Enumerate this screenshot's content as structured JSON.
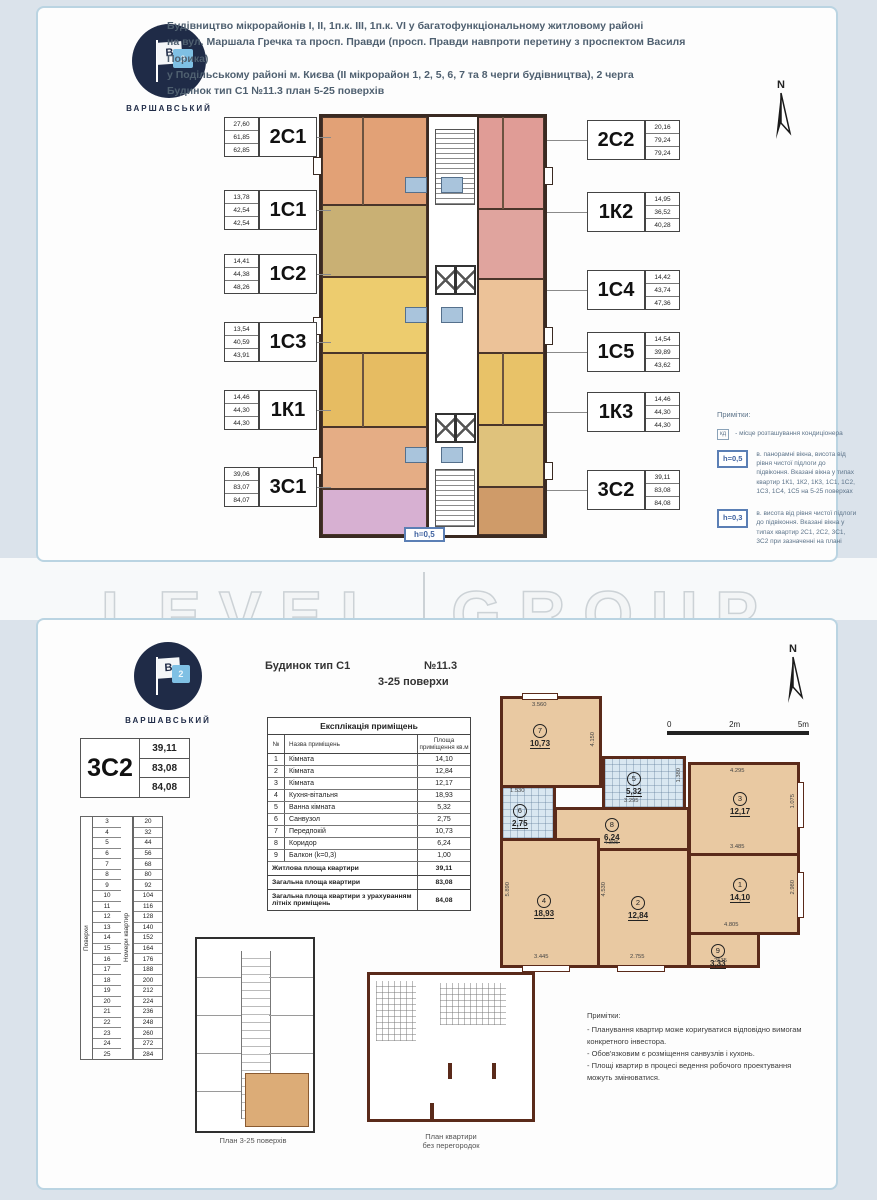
{
  "palette": {
    "page_bg": "#dbe3eb",
    "doc_border": "#bad4e2",
    "wall_dark": "#3a2a22",
    "wall_brown": "#5a2a1a",
    "room_tan": "#e9c9a2",
    "tile_blue": "#d9e7f1",
    "logo_navy": "#1f2b47",
    "logo_blue": "#7fc0e4",
    "tag_blue": "#3f62a0",
    "units": {
      "u2C1": "#e2a176",
      "u1C1": "#c9b074",
      "u1C2": "#edcc6e",
      "u1C3": "#e6bc62",
      "u1K1": "#e5ad85",
      "u3C1": "#d7b0d2",
      "u2C2": "#e09c96",
      "u1K2": "#e0a49e",
      "u1C4": "#ecc298",
      "u1C5": "#e8c268",
      "u1K3": "#dfc27c",
      "u3C2": "#cf9b69"
    }
  },
  "watermark": {
    "left": "LEVEL",
    "right": "GROUP"
  },
  "top_doc": {
    "logo": {
      "brand": "ВАРШАВСЬКИЙ",
      "flag_letter": "В",
      "flag_number": "2"
    },
    "header_lines": [
      "Будівництво мікрорайонів I, II, 1п.к. III, 1п.к. VI у багатофункціональному житловому районі",
      "на вул. Маршала Гречка та просп. Правди (просп. Правди навпроти перетину з проспектом Василя Порика)",
      "у Подільському районі м. Києва (II мікрорайон 1, 2, 5, 6, 7 та 8 черги будівництва), 2 черга",
      "Будинок тип С1    №11.3    план 5-25 поверхів"
    ],
    "north_label": "N",
    "left_units": [
      {
        "code": "2С1",
        "values": [
          "27,60",
          "61,85",
          "62,85"
        ]
      },
      {
        "code": "1С1",
        "values": [
          "13,78",
          "42,54",
          "42,54"
        ]
      },
      {
        "code": "1С2",
        "values": [
          "14,41",
          "44,38",
          "48,26"
        ]
      },
      {
        "code": "1С3",
        "values": [
          "13,54",
          "40,59",
          "43,91"
        ]
      },
      {
        "code": "1К1",
        "values": [
          "14,46",
          "44,30",
          "44,30"
        ]
      },
      {
        "code": "3С1",
        "values": [
          "39,06",
          "83,07",
          "84,07"
        ]
      }
    ],
    "right_units": [
      {
        "code": "2С2",
        "values": [
          "20,16",
          "79,24",
          "79,24"
        ]
      },
      {
        "code": "1К2",
        "values": [
          "14,95",
          "36,52",
          "40,28"
        ]
      },
      {
        "code": "1С4",
        "values": [
          "14,42",
          "43,74",
          "47,36"
        ]
      },
      {
        "code": "1С5",
        "values": [
          "14,54",
          "39,89",
          "43,62"
        ]
      },
      {
        "code": "1К3",
        "values": [
          "14,46",
          "44,30",
          "44,30"
        ]
      },
      {
        "code": "3С2",
        "values": [
          "39,11",
          "83,08",
          "84,08"
        ]
      }
    ],
    "plan_tag": "h=0,5",
    "notes": {
      "title": "Примітки:",
      "ac_symbol": "кд",
      "ac_text": "- місце розташування кондиціонера",
      "items": [
        {
          "tag": "h=0,5",
          "text": "в. панорамні вікна, висота від рівня чистої підлоги до підвіконня. Вказані вікна у типах квартир 1К1, 1К2, 1К3, 1С1, 1С2, 1С3, 1С4, 1С5 на 5-25 поверхах"
        },
        {
          "tag": "h=0,3",
          "text": "в. висота від рівня чистої підлоги до підвіконня. Вказані вікна у типах квартир 2С1, 2С2, 3С1, 3С2 при зазначенні на плані"
        }
      ]
    }
  },
  "bottom_doc": {
    "logo": {
      "brand": "ВАРШАВСЬКИЙ",
      "flag_letter": "В",
      "flag_number": "2"
    },
    "header": {
      "building": "Будинок тип С1",
      "number": "№11.3",
      "floors": "3-25 поверхи"
    },
    "north_label": "N",
    "unit_summary": {
      "code": "3С2",
      "values": [
        "39,11",
        "83,08",
        "84,08"
      ]
    },
    "floors_table": {
      "col1_header": "Поверхи",
      "col2_header": "Номери квартир",
      "floors": [
        "3",
        "4",
        "5",
        "6",
        "7",
        "8",
        "9",
        "10",
        "11",
        "12",
        "13",
        "14",
        "15",
        "16",
        "17",
        "18",
        "19",
        "20",
        "21",
        "22",
        "23",
        "24",
        "25"
      ],
      "apts": [
        "20",
        "32",
        "44",
        "56",
        "68",
        "80",
        "92",
        "104",
        "116",
        "128",
        "140",
        "152",
        "164",
        "176",
        "188",
        "200",
        "212",
        "224",
        "236",
        "248",
        "260",
        "272",
        "284"
      ]
    },
    "explication": {
      "title": "Експлікація приміщень",
      "col_num": "№",
      "col_name": "Назва приміщень",
      "col_area": "Площа приміщення кв.м",
      "rows": [
        {
          "n": "1",
          "name": "Кімната",
          "area": "14,10"
        },
        {
          "n": "2",
          "name": "Кімната",
          "area": "12,84"
        },
        {
          "n": "3",
          "name": "Кімната",
          "area": "12,17"
        },
        {
          "n": "4",
          "name": "Кухня-вітальня",
          "area": "18,93"
        },
        {
          "n": "5",
          "name": "Ванна кімната",
          "area": "5,32"
        },
        {
          "n": "6",
          "name": "Санвузол",
          "area": "2,75"
        },
        {
          "n": "7",
          "name": "Передпокій",
          "area": "10,73"
        },
        {
          "n": "8",
          "name": "Коридор",
          "area": "6,24"
        },
        {
          "n": "9",
          "name": "Балкон (k=0,3)",
          "area": "1,00"
        }
      ],
      "totals": [
        {
          "label": "Житлова площа квартири",
          "value": "39,11"
        },
        {
          "label": "Загальна площа квартири",
          "value": "83,08"
        },
        {
          "label": "Загальна площа квартири з урахуванням літніх приміщень",
          "value": "84,08"
        }
      ]
    },
    "plan": {
      "rooms": {
        "r1": {
          "num": "1",
          "area": "14,10"
        },
        "r2": {
          "num": "2",
          "area": "12,84"
        },
        "r3": {
          "num": "3",
          "area": "12,17"
        },
        "r4": {
          "num": "4",
          "area": "18,93"
        },
        "r5": {
          "num": "5",
          "area": "5,32"
        },
        "r6": {
          "num": "6",
          "area": "2,75"
        },
        "r7": {
          "num": "7",
          "area": "10,73"
        },
        "r8": {
          "num": "8",
          "area": "6,24"
        },
        "r9": {
          "num": "9",
          "area": "3,33"
        }
      },
      "dims": {
        "hall_top": "3.560",
        "hall_right": "4.150",
        "wc_top": "1.530",
        "bath_bottom": "3.295",
        "bath_right": "1.380",
        "corr_bottom": "4.305",
        "r3_top": "4.295",
        "r3_bottom": "3.485",
        "r3_right": "1.075",
        "r1_bottom": "4.805",
        "r1_right": "2.980",
        "r4_bottom": "3.445",
        "r4_left": "5.890",
        "r2_bottom": "2.755",
        "r2_left": "4.530",
        "balc_bottom": "2535"
      },
      "scale": {
        "zero": "0",
        "mid": "2m",
        "end": "5m"
      }
    },
    "captions": {
      "key_plan": "План 3-25 поверхів",
      "open_plan_line1": "План квартири",
      "open_plan_line2": "без перегородок"
    },
    "notes": {
      "title": "Примітки:",
      "items": [
        "- Планування квартир може коригуватися відповідно вимогам конкретного інвестора.",
        "- Обов'язковим є розміщення санвузлів і кухонь.",
        "- Площі квартир в процесі ведення робочого проектування можуть змінюватися."
      ]
    }
  }
}
